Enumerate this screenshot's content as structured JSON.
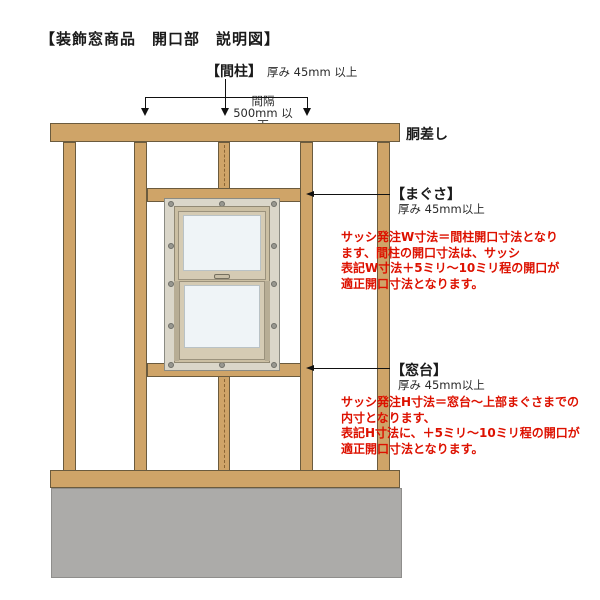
{
  "title": "【装飾窓商品　開口部　説明図】",
  "colors": {
    "wood": "#CFA468",
    "wood_outline": "#6B5B3E",
    "foundation_gray": "#ACABA9",
    "window_flange": "#DAD6C9",
    "window_frame": "#CBBFA3",
    "sash": "#D5CBB4",
    "glass": "#EFF4F7",
    "note_red": "#DD1100",
    "text_black": "#1A1A1A"
  },
  "labels": {
    "stud": {
      "name": "【間柱】",
      "thickness": "厚み 45mm 以上"
    },
    "spacing": {
      "line1": "間隔",
      "line2": "500mm 以下"
    },
    "girder": "胴差し",
    "lintel": {
      "name": "【まぐさ】",
      "thickness": "厚み 45mm以上"
    },
    "sill": {
      "name": "【窓台】",
      "thickness": "厚み 45mm以上"
    }
  },
  "notes": {
    "w": [
      "サッシ発注W寸法＝間柱開口寸法となり",
      "ます、間柱の開口寸法は、サッシ",
      "表記W寸法＋5ミリ～10ミリ程の開口が",
      "適正開口寸法となります。"
    ],
    "h": [
      "サッシ発注H寸法＝窓台～上部まぐさまでの",
      "内寸となります、",
      "表記H寸法に、＋5ミリ～10ミリ程の開口が",
      "適正開口寸法となります。"
    ]
  }
}
